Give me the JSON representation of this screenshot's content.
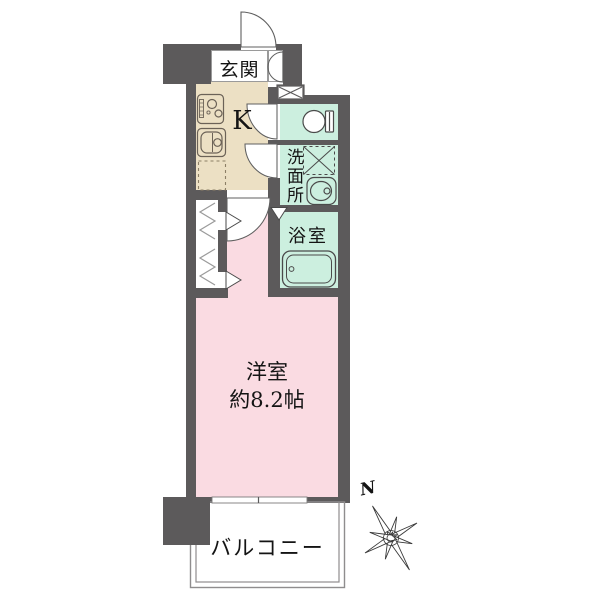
{
  "plan": {
    "type": "apartment-floorplan-1K",
    "rooms": {
      "genkan": {
        "label": "玄関"
      },
      "kitchen": {
        "label": "K"
      },
      "washroom": {
        "label": "洗面所"
      },
      "bathroom": {
        "label": "浴室"
      },
      "main_room": {
        "label": "洋室",
        "size": "約8.2帖"
      },
      "balcony": {
        "label": "バルコニー"
      }
    },
    "compass": {
      "north": "N"
    },
    "colors": {
      "wall": "#5c5a5b",
      "kitchen_floor": "#ece0c4",
      "wet_area": "#ccefdf",
      "main_room": "#fadbe2",
      "icon_outline": "#4a4a4a",
      "balcony_outline": "#8f8d8e"
    }
  }
}
